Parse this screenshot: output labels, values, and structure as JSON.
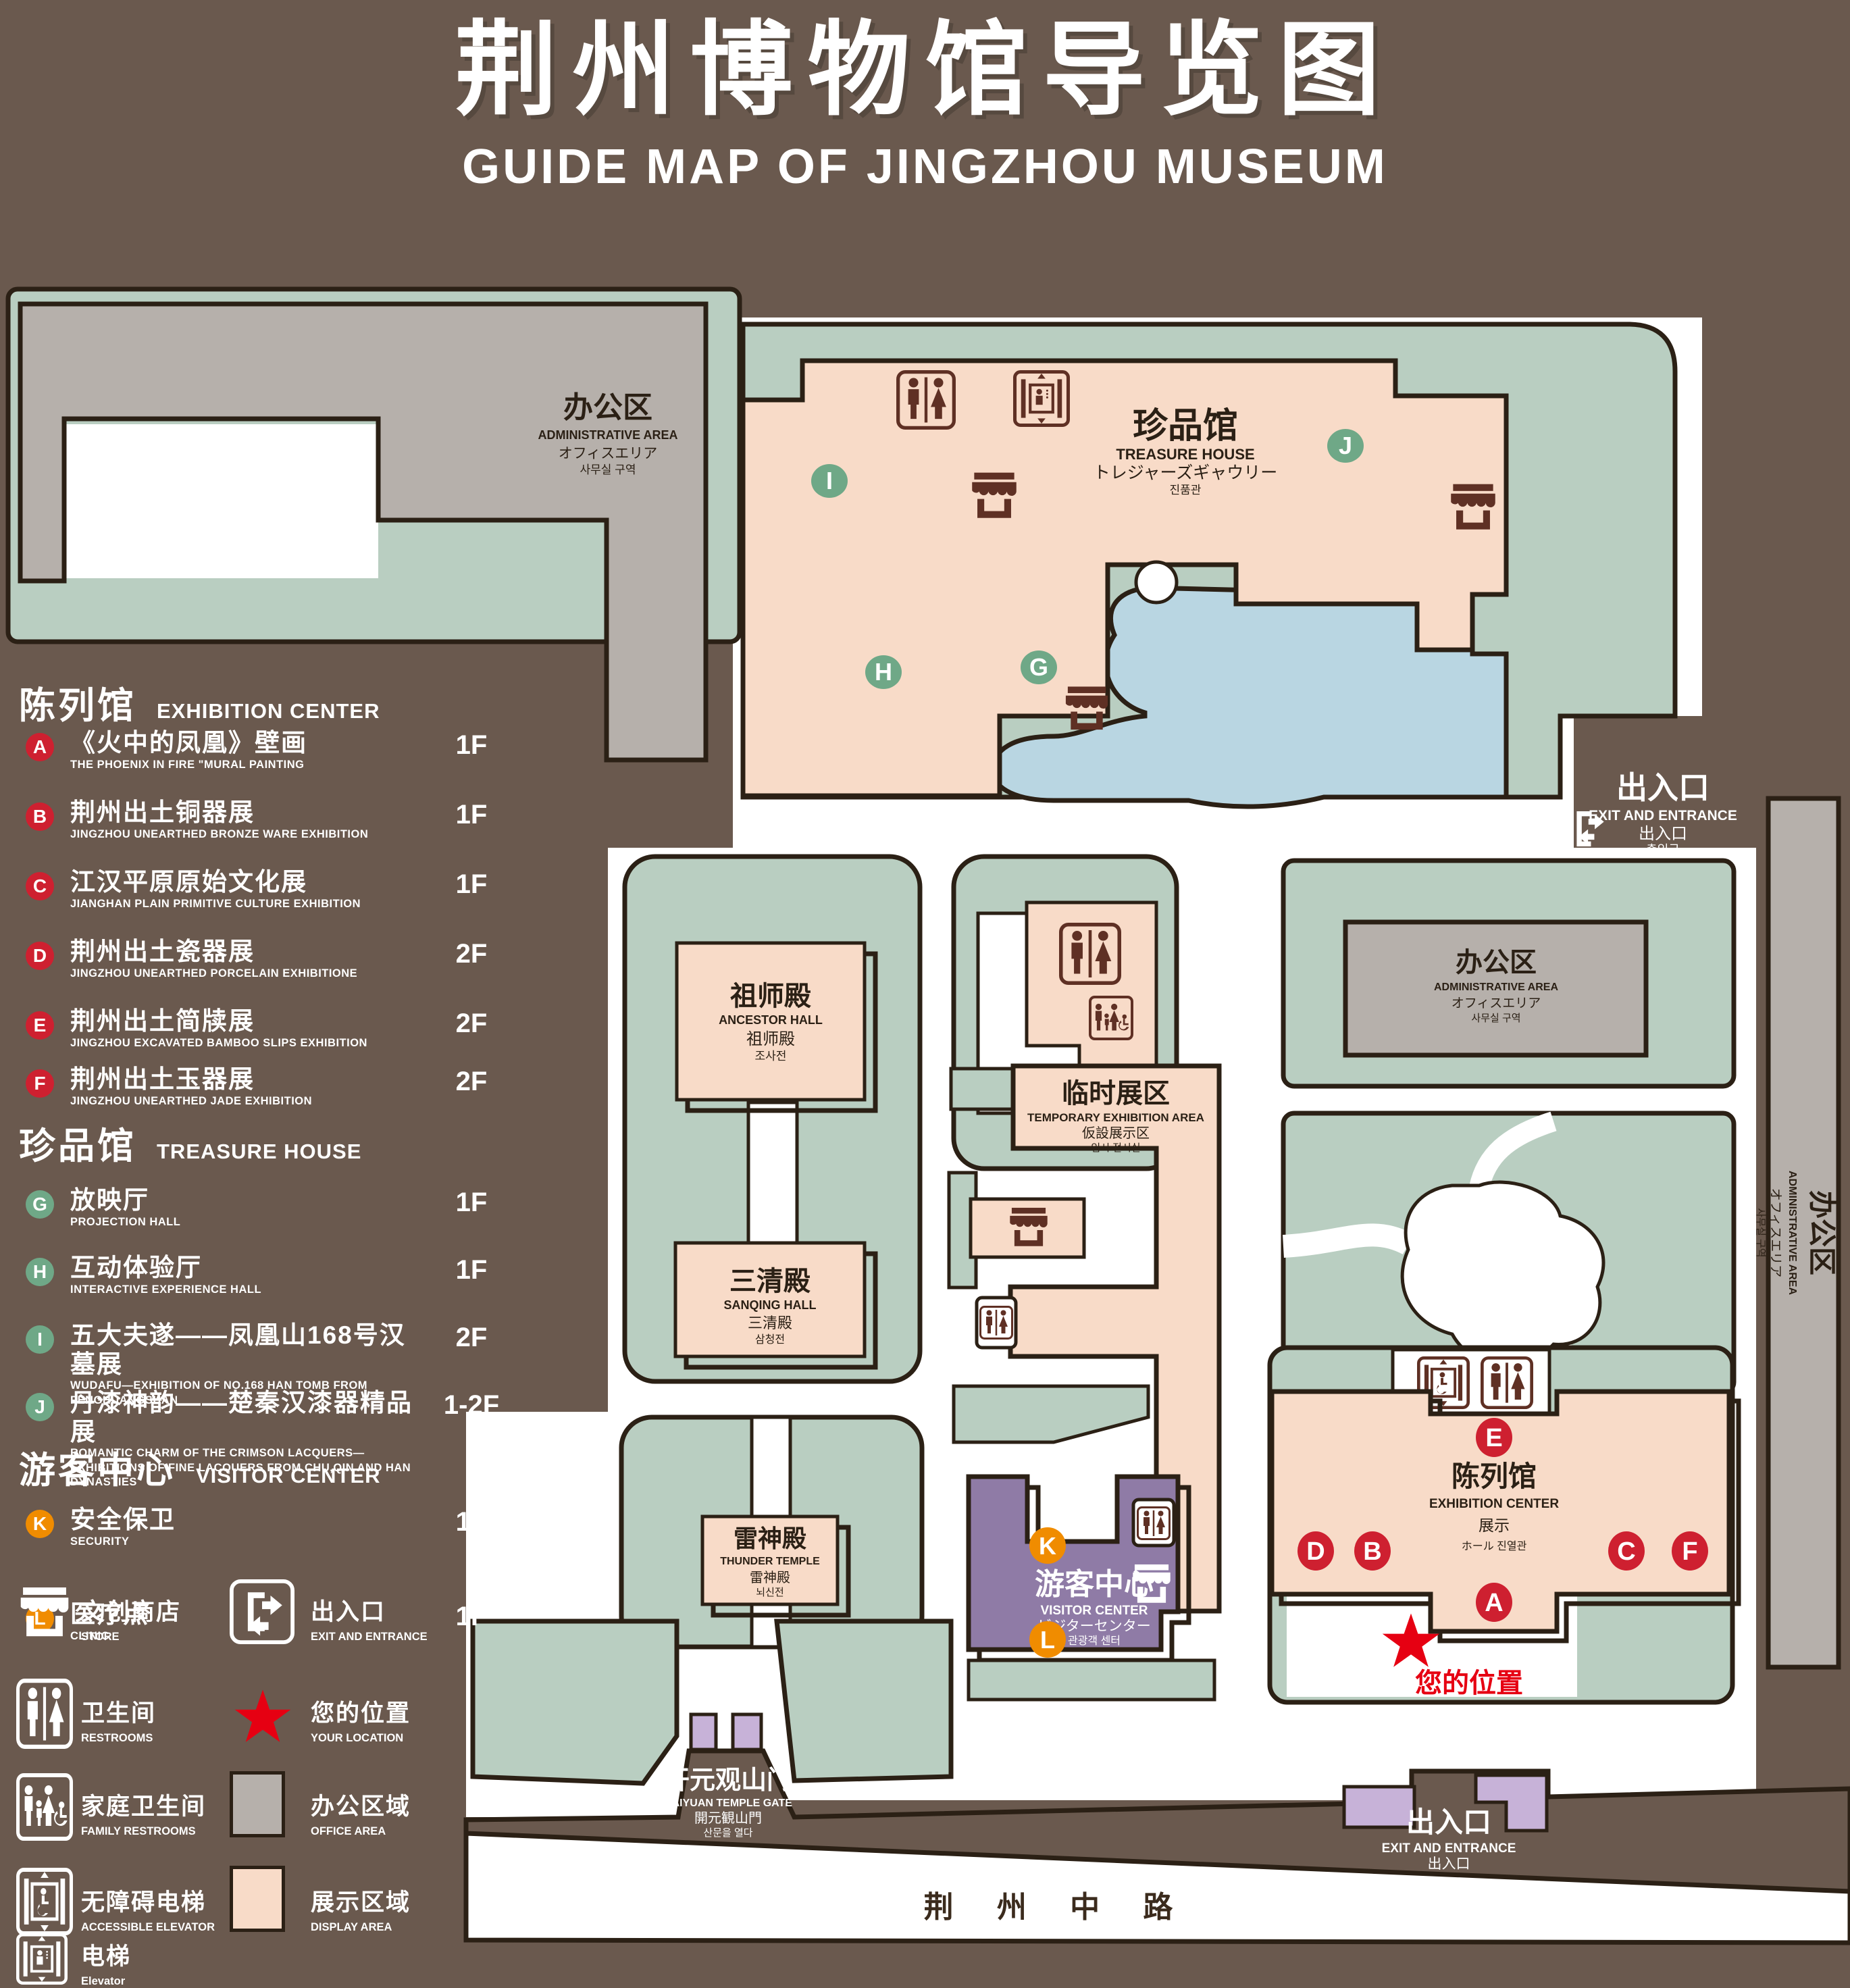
{
  "title": {
    "zh": "荆州博物馆导览图",
    "en": "GUIDE MAP OF JINGZHOU MUSEUM"
  },
  "colors": {
    "bg": "#6A594E",
    "outline": "#2B2015",
    "green": "#B9CEC1",
    "pink": "#F8DBC8",
    "gray": "#B6B0AB",
    "blue": "#B9D6E2",
    "purple": "#8F7BA6",
    "lpurple": "#C7B2D8",
    "icon": "#5F3024",
    "red": "#CE2030",
    "mgreen": "#6FA887",
    "orange": "#F08C00",
    "star": "#E60012",
    "roadtext": "#3B2B1D"
  },
  "legend": {
    "sections": [
      {
        "zh": "陈列馆",
        "en": "EXHIBITION CENTER",
        "items": [
          {
            "letter": "A",
            "zh": "《火中的凤凰》壁画",
            "en": "THE PHOENIX IN FIRE \"MURAL PAINTING",
            "floor": "1F"
          },
          {
            "letter": "B",
            "zh": "荆州出土铜器展",
            "en": "JINGZHOU UNEARTHED BRONZE WARE EXHIBITION",
            "floor": "1F"
          },
          {
            "letter": "C",
            "zh": "江汉平原原始文化展",
            "en": "JIANGHAN PLAIN PRIMITIVE CULTURE EXHIBITION",
            "floor": "1F"
          },
          {
            "letter": "D",
            "zh": "荆州出土瓷器展",
            "en": "JINGZHOU UNEARTHED PORCELAIN EXHIBITIONE",
            "floor": "2F"
          },
          {
            "letter": "E",
            "zh": "荆州出土简牍展",
            "en": "JINGZHOU EXCAVATED BAMBOO SLIPS EXHIBITION",
            "floor": "2F"
          },
          {
            "letter": "F",
            "zh": "荆州出土玉器展",
            "en": "JINGZHOU UNEARTHED JADE EXHIBITION",
            "floor": "2F"
          }
        ]
      },
      {
        "zh": "珍品馆",
        "en": "TREASURE HOUSE",
        "items": [
          {
            "letter": "G",
            "zh": "放映厅",
            "en": "PROJECTION HALL",
            "floor": "1F"
          },
          {
            "letter": "H",
            "zh": "互动体验厅",
            "en": "INTERACTIVE EXPERIENCE HALL",
            "floor": "1F"
          },
          {
            "letter": "I",
            "zh": "五大夫遂——凤凰山168号汉墓展",
            "en": "WUDAFU—EXHIBITION OF NO.168 HAN TOMB FROM FENGHUANGSHAN",
            "floor": "2F"
          },
          {
            "letter": "J",
            "zh": "丹漆神韵——楚秦汉漆器精品展",
            "en": "ROMANTIC CHARM OF THE CRIMSON LACQUERS—EXHIBITIONS OF FINE LACQUERS FROM CHU,QIN AND HAN DYNASTIES",
            "floor": "1-2F"
          }
        ]
      },
      {
        "zh": "游客中心",
        "en": "VISITOR CENTER",
        "items": [
          {
            "letter": "K",
            "zh": "安全保卫",
            "en": "SECURITY",
            "floor": "1F"
          },
          {
            "letter": "L",
            "zh": "医疗点",
            "en": "CLINIC",
            "floor": "1F"
          }
        ]
      }
    ],
    "symbols": {
      "store": {
        "zh": "文创商店",
        "en": "STORE"
      },
      "exit": {
        "zh": "出入口",
        "en": "EXIT AND ENTRANCE"
      },
      "restrooms": {
        "zh": "卫生间",
        "en": "RESTROOMS"
      },
      "location": {
        "zh": "您的位置",
        "en": "YOUR LOCATION"
      },
      "family": {
        "zh": "家庭卫生间",
        "en": "FAMILY RESTROOMS"
      },
      "office": {
        "zh": "办公区域",
        "en": "OFFICE AREA"
      },
      "accessible": {
        "zh": "无障碍电梯",
        "en": "ACCESSIBLE ELEVATOR"
      },
      "display": {
        "zh": "展示区域",
        "en": "DISPLAY AREA"
      },
      "elevator": {
        "zh": "电梯",
        "en": "Elevator"
      }
    }
  },
  "map": {
    "buildings": {
      "admin_nw": {
        "zh": "办公区",
        "en": "ADMINISTRATIVE AREA",
        "ja": "オフィスエリア",
        "ko": "사무실 구역"
      },
      "treasure": {
        "zh": "珍品馆",
        "en": "TREASURE HOUSE",
        "ja": "トレジャーズギャウリー",
        "ko": "진품관"
      },
      "ancestor": {
        "zh": "祖师殿",
        "en": "ANCESTOR HALL",
        "ja": "祖师殿",
        "ko": "조사전"
      },
      "sanqing": {
        "zh": "三清殿",
        "en": "SANQING HALL",
        "ja": "三清殿",
        "ko": "삼청전"
      },
      "thunder": {
        "zh": "雷神殿",
        "en": "THUNDER TEMPLE",
        "ja": "雷神殿",
        "ko": "뇌신전"
      },
      "temporary": {
        "zh": "临时展区",
        "en": "TEMPORARY EXHIBITION AREA",
        "ja": "仮設展示区",
        "ko": "임시 전시실"
      },
      "admin_mid": {
        "zh": "办公区",
        "en": "ADMINISTRATIVE AREA",
        "ja": "オフィスエリア",
        "ko": "사무실 구역"
      },
      "admin_east": {
        "zh": "办公区",
        "en": "ADMINISTRATIVE AREA",
        "ja": "オフィスエリア",
        "ko": "사무실 구역"
      },
      "exhibition": {
        "zh": "陈列馆",
        "en": "EXHIBITION CENTER",
        "ja": "展示",
        "ko": "ホール 진열관"
      },
      "visitor": {
        "zh": "游客中心",
        "en": "VISITOR CENTER",
        "ja": "ビジターセンター",
        "ko": "관광객 센터"
      },
      "gate": {
        "zh": "开元观山门",
        "en": "KAIYUAN TEMPLE GATE",
        "ja": "開元観山門",
        "ko": "산문을 열다"
      },
      "exit_ne": {
        "zh": "出入口",
        "en": "EXIT AND ENTRANCE",
        "ja": "出入口",
        "ko": "출입구"
      },
      "exit_s": {
        "zh": "出入口",
        "en": "EXIT AND ENTRANCE",
        "ja": "出入口",
        "ko": "출입구"
      },
      "road": {
        "zh": "荆 州 中 路"
      },
      "your_location": {
        "zh": "您的位置"
      }
    },
    "markers": [
      {
        "letter": "I"
      },
      {
        "letter": "J"
      },
      {
        "letter": "H"
      },
      {
        "letter": "G"
      },
      {
        "letter": "E"
      },
      {
        "letter": "D"
      },
      {
        "letter": "B"
      },
      {
        "letter": "C"
      },
      {
        "letter": "F"
      },
      {
        "letter": "A"
      },
      {
        "letter": "K"
      },
      {
        "letter": "L"
      }
    ]
  }
}
